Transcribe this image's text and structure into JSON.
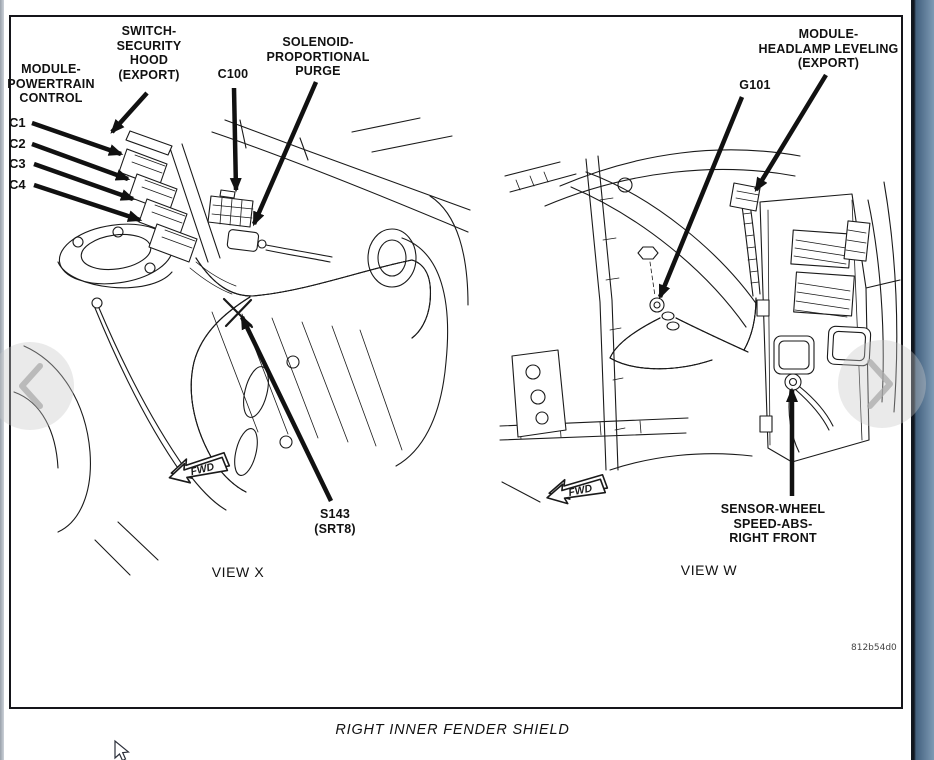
{
  "figure": {
    "caption": "RIGHT INNER FENDER SHIELD",
    "code": "812b54d0"
  },
  "view_x": {
    "title": "VIEW X",
    "fwd_label": "FWD",
    "labels": {
      "module_powertrain": "MODULE-\nPOWERTRAIN\nCONTROL",
      "switch_security_hood": "SWITCH-\nSECURITY\nHOOD\n(EXPORT)",
      "c100": "C100",
      "solenoid_purge": "SOLENOID-\nPROPORTIONAL\nPURGE",
      "connectors": [
        "C1",
        "C2",
        "C3",
        "C4"
      ],
      "s143": "S143\n(SRT8)"
    }
  },
  "view_w": {
    "title": "VIEW W",
    "fwd_label": "FWD",
    "labels": {
      "module_headlamp": "MODULE-\nHEADLAMP LEVELING\n(EXPORT)",
      "g101": "G101",
      "wheel_speed_sensor": "SENSOR-WHEEL\nSPEED-ABS-\nRIGHT FRONT"
    }
  },
  "colors": {
    "line": "#1a1a1a",
    "paper": "#ffffff",
    "window_edge_dark": "#10161f",
    "window_edge_light": "#7e9ab4"
  }
}
